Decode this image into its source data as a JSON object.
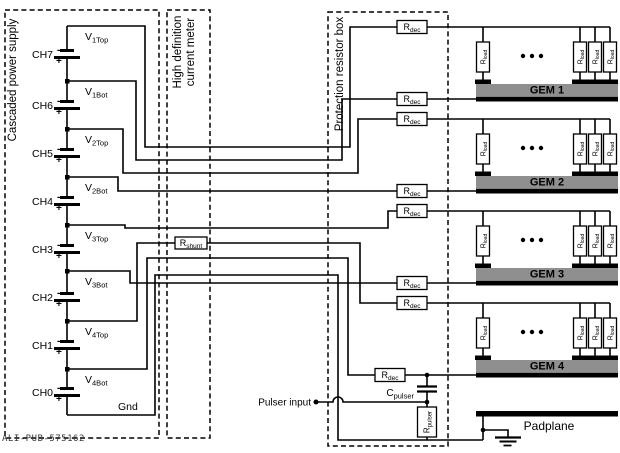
{
  "boxes": {
    "power_supply_label": "Cascaded power supply",
    "meter_label_line1": "High definition",
    "meter_label_line2": "current meter",
    "protection_label": "Protection resistor box"
  },
  "power_supply": {
    "channels": [
      {
        "label": "CH7"
      },
      {
        "label": "CH6"
      },
      {
        "label": "CH5"
      },
      {
        "label": "CH4"
      },
      {
        "label": "CH3"
      },
      {
        "label": "CH2"
      },
      {
        "label": "CH1"
      },
      {
        "label": "CH0"
      }
    ],
    "polarity": {
      "minus": "-",
      "plus": "+"
    },
    "taps": [
      {
        "main": "V",
        "sub": "1Top"
      },
      {
        "main": "V",
        "sub": "1Bot"
      },
      {
        "main": "V",
        "sub": "2Top"
      },
      {
        "main": "V",
        "sub": "2Bot"
      },
      {
        "main": "V",
        "sub": "3Top"
      },
      {
        "main": "V",
        "sub": "3Bot"
      },
      {
        "main": "V",
        "sub": "4Top"
      },
      {
        "main": "V",
        "sub": "4Bot"
      }
    ],
    "ground_label": "Gnd"
  },
  "resistors": {
    "dec": {
      "main": "R",
      "sub": "dec"
    },
    "shunt": {
      "main": "R",
      "sub": "shunt"
    },
    "load": {
      "main": "R",
      "sub": "load"
    },
    "pulser": {
      "main": "R",
      "sub": "pulser"
    }
  },
  "capacitor": {
    "main": "C",
    "sub": "pulser"
  },
  "gems": [
    {
      "label": "GEM 1"
    },
    {
      "label": "GEM 2"
    },
    {
      "label": "GEM 3"
    },
    {
      "label": "GEM 4"
    }
  ],
  "pulser_input_label": "Pulser input",
  "padplane_label": "Padplane",
  "watermark": "ALI-PUB-575162",
  "colors": {
    "wire": "#000000",
    "gem_bar": "#8f8f8f",
    "background": "#ffffff"
  }
}
